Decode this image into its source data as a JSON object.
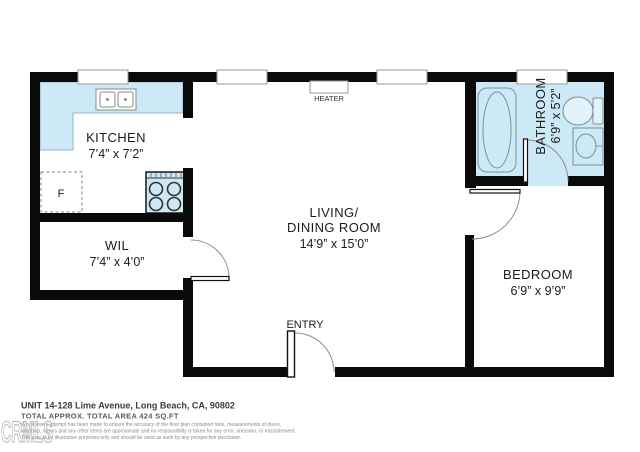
{
  "plan": {
    "rooms": {
      "kitchen": {
        "label": "KITCHEN",
        "dims": "7’4” x 7’2”"
      },
      "wil": {
        "label": "WIL",
        "dims": "7’4” x 4’0”"
      },
      "living": {
        "label_line1": "LIVING/",
        "label_line2": "DINING ROOM",
        "dims": "14’9” x 15’0”"
      },
      "bathroom": {
        "label": "BATHROOM",
        "dims": "6’9” x 5’2”"
      },
      "bedroom": {
        "label": "BEDROOM",
        "dims": "6’9” x 9’9”"
      }
    },
    "fixtures": {
      "fridge_label": "F",
      "heater_label": "HEATER",
      "entry_label": "ENTRY"
    },
    "colors": {
      "wall": "#0a0a0a",
      "fixture_fill": "#cde9f6",
      "outline": "#8c8c8c"
    }
  },
  "footer": {
    "address": "UNIT 14-128 Lime Avenue, Long Beach, CA, 90802",
    "area": "TOTAL APPROX. TOTAL AREA 424 SQ.FT",
    "disclaimer_line1": "Whilst every attempt has been made to ensure the accuracy of the floor plan contained here, measurements of doors,",
    "disclaimer_line2": "windows, rooms and any other items are approximate and no responsibility is taken for any error, omission, or misstatement.",
    "disclaimer_line3": "This plan is for illustrative purposes only and should be used as such by any prospective purchaser.",
    "watermark": "CRMLS"
  }
}
